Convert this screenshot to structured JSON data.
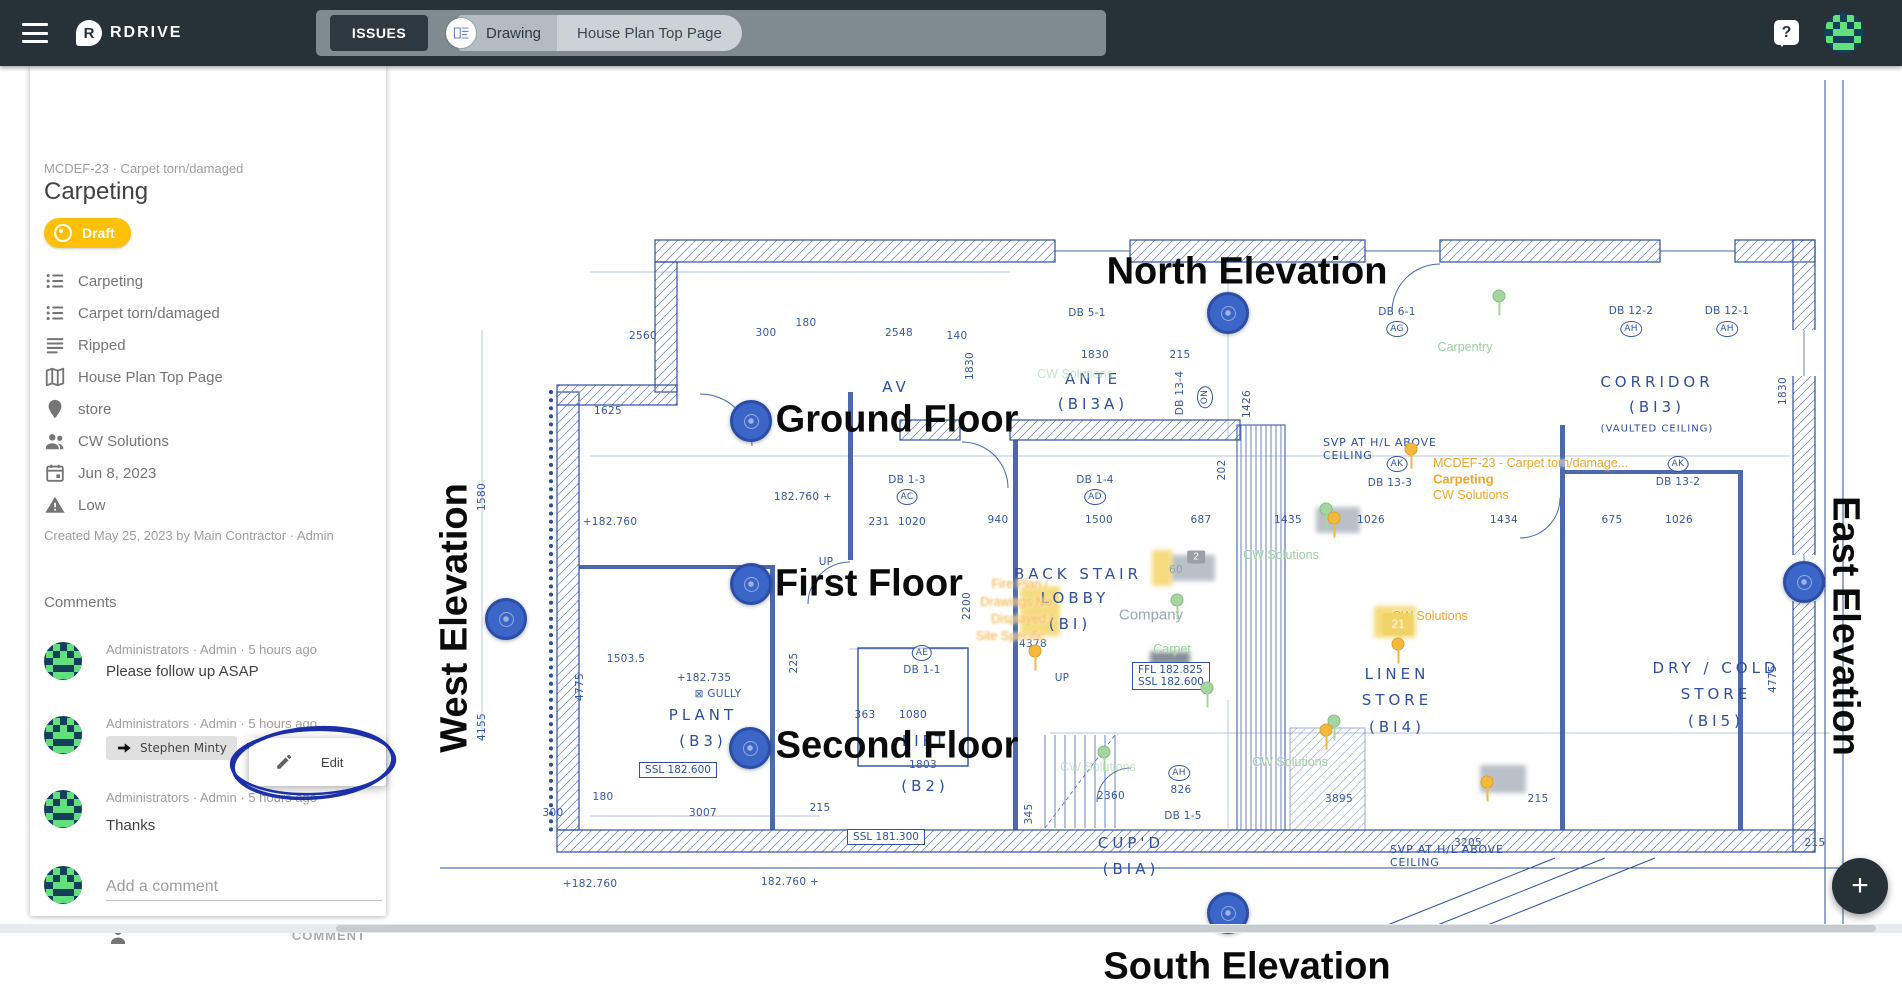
{
  "topbar": {
    "brand": "RDRIVE",
    "logo_letter": "R",
    "issues_button": "ISSUES",
    "tab_drawing": "Drawing",
    "tab_page": "House Plan Top Page",
    "help": "?"
  },
  "fab": {
    "plus": "+"
  },
  "colors": {
    "appbar": "#263238",
    "accent": "#FFC107",
    "pin": "#3b66c7",
    "blueprint": "#2e4f9f",
    "annotation": "#1b2fa8",
    "overlay_orange": "#f2a52b"
  },
  "sidebar": {
    "breadcrumb": "MCDEF-23 · Carpet torn/damaged",
    "title": "Carpeting",
    "status": "Draft",
    "properties": [
      {
        "icon": "list-bulleted-icon",
        "label": "Carpeting"
      },
      {
        "icon": "list-bulleted-icon",
        "label": "Carpet torn/damaged"
      },
      {
        "icon": "notes-icon",
        "label": "Ripped"
      },
      {
        "icon": "map-icon",
        "label": "House Plan Top Page"
      },
      {
        "icon": "place-pin-icon",
        "label": "store"
      },
      {
        "icon": "people-icon",
        "label": "CW Solutions"
      },
      {
        "icon": "calendar-icon",
        "label": "Jun 8, 2023"
      },
      {
        "icon": "warning-icon",
        "label": "Low"
      }
    ],
    "created": "Created May 25, 2023 by Main Contractor · Admin",
    "comments_heading": "Comments",
    "comments": [
      {
        "meta": "Administrators · Admin · 5 hours ago",
        "body": "Please follow up ASAP"
      },
      {
        "meta": "Administrators · Admin · 5 hours ago",
        "reply_to": "Stephen Minty",
        "body": "Will do"
      },
      {
        "meta": "Administrators · Admin · 5 hours ago",
        "body": "Thanks"
      }
    ],
    "add_comment_placeholder": "Add a comment",
    "comment_button": "COMMENT",
    "edit_popup": "Edit"
  },
  "drawing": {
    "big_labels": [
      {
        "t": "North Elevation",
        "x": 1247,
        "y": 206
      },
      {
        "t": "Ground Floor",
        "x": 897,
        "y": 354
      },
      {
        "t": "First Floor",
        "x": 869,
        "y": 518
      },
      {
        "t": "Second Floor",
        "x": 897,
        "y": 680
      },
      {
        "t": "South Elevation",
        "x": 1247,
        "y": 901
      },
      {
        "t": "West Elevation",
        "x": 455,
        "y": 552,
        "r": -90
      },
      {
        "t": "East Elevation",
        "x": 1845,
        "y": 560,
        "r": 90
      }
    ],
    "pins": [
      {
        "x": 1228,
        "y": 247,
        "n": "north-elevation-pin"
      },
      {
        "x": 751,
        "y": 355,
        "n": "ground-floor-pin"
      },
      {
        "x": 751,
        "y": 518,
        "n": "first-floor-pin"
      },
      {
        "x": 750,
        "y": 682,
        "n": "second-floor-pin"
      },
      {
        "x": 506,
        "y": 553,
        "n": "west-elevation-pin"
      },
      {
        "x": 1804,
        "y": 516,
        "n": "east-elevation-pin"
      },
      {
        "x": 1228,
        "y": 847,
        "n": "south-elevation-pin"
      }
    ],
    "rooms": [
      {
        "t": "AV",
        "x": 896,
        "y": 321
      },
      {
        "t": "ANTE",
        "x": 1093,
        "y": 313
      },
      {
        "t": "(BI3A)",
        "x": 1093,
        "y": 338
      },
      {
        "t": "CORRIDOR",
        "x": 1657,
        "y": 316
      },
      {
        "t": "(BI3)",
        "x": 1657,
        "y": 341
      },
      {
        "t": "(VAULTED CEILING)",
        "x": 1657,
        "y": 363,
        "cls": "room-s"
      },
      {
        "t": "BACK STAIR",
        "x": 1078,
        "y": 508
      },
      {
        "t": "LOBBY",
        "x": 1075,
        "y": 532
      },
      {
        "t": "(BI)",
        "x": 1070,
        "y": 558
      },
      {
        "t": "LINEN",
        "x": 1397,
        "y": 608
      },
      {
        "t": "STORE",
        "x": 1397,
        "y": 634
      },
      {
        "t": "(BI4)",
        "x": 1397,
        "y": 661
      },
      {
        "t": "DRY / COLD",
        "x": 1716,
        "y": 602
      },
      {
        "t": "STORE",
        "x": 1716,
        "y": 628
      },
      {
        "t": "(BI5)",
        "x": 1716,
        "y": 655
      },
      {
        "t": "PLANT",
        "x": 703,
        "y": 649
      },
      {
        "t": "(B3)",
        "x": 703,
        "y": 675
      },
      {
        "t": "LIFT",
        "x": 925,
        "y": 675
      },
      {
        "t": "(B2)",
        "x": 925,
        "y": 720
      },
      {
        "t": "CUP'D",
        "x": 1131,
        "y": 777
      },
      {
        "t": "(BIA)",
        "x": 1131,
        "y": 803
      }
    ],
    "dims": [
      {
        "t": "2560",
        "x": 643,
        "y": 270
      },
      {
        "t": "300",
        "x": 766,
        "y": 267
      },
      {
        "t": "180",
        "x": 806,
        "y": 257
      },
      {
        "t": "2548",
        "x": 899,
        "y": 267
      },
      {
        "t": "140",
        "x": 957,
        "y": 270
      },
      {
        "t": "1830",
        "x": 1095,
        "y": 289
      },
      {
        "t": "215",
        "x": 1180,
        "y": 289
      },
      {
        "t": "1830",
        "x": 970,
        "y": 300,
        "r": -90
      },
      {
        "t": "1625",
        "x": 608,
        "y": 345
      },
      {
        "t": "182.760 +",
        "x": 803,
        "y": 431
      },
      {
        "t": "+182.760",
        "x": 610,
        "y": 456
      },
      {
        "t": "231",
        "x": 879,
        "y": 456
      },
      {
        "t": "1020",
        "x": 912,
        "y": 456
      },
      {
        "t": "940",
        "x": 998,
        "y": 454
      },
      {
        "t": "1500",
        "x": 1099,
        "y": 454
      },
      {
        "t": "687",
        "x": 1201,
        "y": 454
      },
      {
        "t": "1435",
        "x": 1288,
        "y": 454
      },
      {
        "t": "1026",
        "x": 1371,
        "y": 454
      },
      {
        "t": "1434",
        "x": 1504,
        "y": 454
      },
      {
        "t": "675",
        "x": 1612,
        "y": 454
      },
      {
        "t": "1026",
        "x": 1679,
        "y": 454
      },
      {
        "t": "1580",
        "x": 482,
        "y": 431,
        "r": -90
      },
      {
        "t": "4155",
        "x": 482,
        "y": 661,
        "r": -90
      },
      {
        "t": "4775",
        "x": 580,
        "y": 621,
        "r": -90
      },
      {
        "t": "225",
        "x": 794,
        "y": 597,
        "r": -90
      },
      {
        "t": "202",
        "x": 1222,
        "y": 404,
        "r": -90
      },
      {
        "t": "1426",
        "x": 1247,
        "y": 338,
        "r": -90
      },
      {
        "t": "2200",
        "x": 967,
        "y": 540,
        "r": -90
      },
      {
        "t": "345",
        "x": 1029,
        "y": 748,
        "r": -90
      },
      {
        "t": "1830",
        "x": 1783,
        "y": 325,
        "r": -90
      },
      {
        "t": "4775",
        "x": 1773,
        "y": 613,
        "r": -90
      },
      {
        "t": "1503.5",
        "x": 626,
        "y": 593
      },
      {
        "t": "363",
        "x": 865,
        "y": 649
      },
      {
        "t": "1080",
        "x": 913,
        "y": 649
      },
      {
        "t": "1803",
        "x": 923,
        "y": 699
      },
      {
        "t": "3007",
        "x": 703,
        "y": 747
      },
      {
        "t": "215",
        "x": 820,
        "y": 742
      },
      {
        "t": "180",
        "x": 603,
        "y": 731
      },
      {
        "t": "300",
        "x": 553,
        "y": 747
      },
      {
        "t": "2360",
        "x": 1111,
        "y": 730
      },
      {
        "t": "3895",
        "x": 1339,
        "y": 733
      },
      {
        "t": "215",
        "x": 1538,
        "y": 733
      },
      {
        "t": "3205",
        "x": 1468,
        "y": 777
      },
      {
        "t": "215",
        "x": 1815,
        "y": 777
      },
      {
        "t": "826",
        "x": 1181,
        "y": 724
      },
      {
        "t": "4378",
        "x": 1033,
        "y": 578
      },
      {
        "t": "+182.735",
        "x": 704,
        "y": 612
      },
      {
        "t": "⊠ GULLY",
        "x": 718,
        "y": 628
      },
      {
        "t": "+182.760",
        "x": 590,
        "y": 818
      },
      {
        "t": "182.760 +",
        "x": 790,
        "y": 816
      },
      {
        "t": "UP",
        "x": 826,
        "y": 496
      },
      {
        "t": "UP",
        "x": 1062,
        "y": 612
      },
      {
        "t": "60",
        "x": 1176,
        "y": 504,
        "cls": "gray"
      },
      {
        "t": "DB 5-1",
        "x": 1087,
        "y": 247
      },
      {
        "t": "DB 6-1",
        "x": 1397,
        "y": 246
      },
      {
        "t": "DB 12-2",
        "x": 1631,
        "y": 245
      },
      {
        "t": "DB 12-1",
        "x": 1727,
        "y": 245
      },
      {
        "t": "DB 1-3",
        "x": 907,
        "y": 414
      },
      {
        "t": "DB 1-4",
        "x": 1095,
        "y": 414
      },
      {
        "t": "DB 13-4",
        "x": 1180,
        "y": 327,
        "r": -90
      },
      {
        "t": "DB 1-1",
        "x": 922,
        "y": 604
      },
      {
        "t": "DB 13-3",
        "x": 1390,
        "y": 417
      },
      {
        "t": "DB 13-2",
        "x": 1678,
        "y": 416
      },
      {
        "t": "DB 1-5",
        "x": 1183,
        "y": 750
      },
      {
        "t": "AG",
        "x": 1397,
        "y": 263,
        "cls": "circ"
      },
      {
        "t": "AH",
        "x": 1631,
        "y": 263,
        "cls": "circ"
      },
      {
        "t": "AH",
        "x": 1727,
        "y": 263,
        "cls": "circ"
      },
      {
        "t": "AC",
        "x": 907,
        "y": 431,
        "cls": "circ"
      },
      {
        "t": "AD",
        "x": 1095,
        "y": 431,
        "cls": "circ"
      },
      {
        "t": "AE",
        "x": 922,
        "y": 587,
        "cls": "circ"
      },
      {
        "t": "AK",
        "x": 1397,
        "y": 398,
        "cls": "circ"
      },
      {
        "t": "AK",
        "x": 1678,
        "y": 398,
        "cls": "circ"
      },
      {
        "t": "ON",
        "x": 1205,
        "y": 331,
        "r": -90,
        "cls": "circ"
      },
      {
        "t": "AH",
        "x": 1179,
        "y": 707,
        "cls": "circ"
      }
    ],
    "levels": [
      {
        "t": "FFL 182.825\nSSL 182.600",
        "x": 1171,
        "y": 610
      },
      {
        "t": "SSL 182.600",
        "x": 678,
        "y": 704
      },
      {
        "t": "SSL 181.300",
        "x": 886,
        "y": 771
      }
    ],
    "notes": [
      {
        "t": "SVP AT H/L ABOVE\nCEILING",
        "x": 1323,
        "y": 383,
        "cls": "la"
      },
      {
        "t": "SVP AT H/L ABOVE\nCEILING",
        "x": 1390,
        "y": 790,
        "cls": "la"
      }
    ],
    "overlays": [
      {
        "t": "MCDEF-23 - Carpet torn/damage...",
        "x": 1433,
        "y": 397,
        "cls": "ov-o la"
      },
      {
        "t": "Carpeting",
        "x": 1433,
        "y": 413,
        "cls": "ov-o ob la"
      },
      {
        "t": "CW Solutions",
        "x": 1433,
        "y": 429,
        "cls": "ov-o la"
      },
      {
        "t": "Carpentry",
        "x": 1465,
        "y": 281,
        "cls": "ov-g"
      },
      {
        "t": "CW Solutions",
        "x": 1281,
        "y": 489,
        "cls": "ov-g"
      },
      {
        "t": "CW Solutions",
        "x": 1430,
        "y": 550,
        "cls": "ov-o"
      },
      {
        "t": "CW Solutions",
        "x": 1290,
        "y": 696,
        "cls": "ov-g"
      },
      {
        "t": "CW Solutions",
        "x": 1098,
        "y": 701,
        "cls": "ov-g faint"
      },
      {
        "t": "CW Solutions",
        "x": 1075,
        "y": 308,
        "cls": "ov-g faint"
      },
      {
        "t": "Company",
        "x": 1151,
        "y": 549,
        "cls": "ov-gray"
      },
      {
        "t": "Carpet",
        "x": 1172,
        "y": 583,
        "cls": "ov-g"
      },
      {
        "t": "Fire Plan /",
        "x": 1020,
        "y": 518,
        "cls": "ov-o blurt"
      },
      {
        "t": "Drawings No",
        "x": 1016,
        "y": 536,
        "cls": "ov-o blurt"
      },
      {
        "t": "Displayed /",
        "x": 1022,
        "y": 553,
        "cls": "ov-o blurt"
      },
      {
        "t": "Site Specific.",
        "x": 1012,
        "y": 570,
        "cls": "ov-o blurt"
      }
    ],
    "badges": [
      {
        "t": "2",
        "x": 1196,
        "y": 491,
        "cls": "badge-gray"
      },
      {
        "t": "21",
        "x": 1398,
        "y": 558,
        "cls": "chip-y"
      }
    ],
    "minipins": [
      {
        "x": 1499,
        "y": 230,
        "cls": "mg"
      },
      {
        "x": 1326,
        "y": 443,
        "cls": "mg"
      },
      {
        "x": 1177,
        "y": 534,
        "cls": "mg"
      },
      {
        "x": 1334,
        "y": 655,
        "cls": "mg"
      },
      {
        "x": 1207,
        "y": 622,
        "cls": "mg"
      },
      {
        "x": 1104,
        "y": 686,
        "cls": "mg"
      },
      {
        "x": 1411,
        "y": 383,
        "cls": "mo"
      },
      {
        "x": 1334,
        "y": 452,
        "cls": "mo"
      },
      {
        "x": 1326,
        "y": 664,
        "cls": "mo"
      },
      {
        "x": 1487,
        "y": 716,
        "cls": "mo"
      },
      {
        "x": 1035,
        "y": 585,
        "cls": "mo"
      },
      {
        "x": 1398,
        "y": 578,
        "cls": "mo"
      }
    ],
    "blurs": [
      {
        "x": 1193,
        "y": 502,
        "w": 44,
        "h": 26,
        "cls": "blur-g"
      },
      {
        "x": 1338,
        "y": 454,
        "w": 44,
        "h": 26,
        "cls": "blur-g"
      },
      {
        "x": 1503,
        "y": 713,
        "w": 46,
        "h": 28,
        "cls": "blur-g"
      },
      {
        "x": 1170,
        "y": 592,
        "w": 40,
        "h": 14,
        "cls": "blur-d"
      },
      {
        "x": 1040,
        "y": 545,
        "w": 40,
        "h": 50,
        "cls": "blur-y"
      },
      {
        "x": 1395,
        "y": 556,
        "w": 42,
        "h": 32,
        "cls": "blur-y"
      },
      {
        "x": 1162,
        "y": 502,
        "w": 20,
        "h": 36,
        "cls": "blur-y"
      }
    ]
  }
}
